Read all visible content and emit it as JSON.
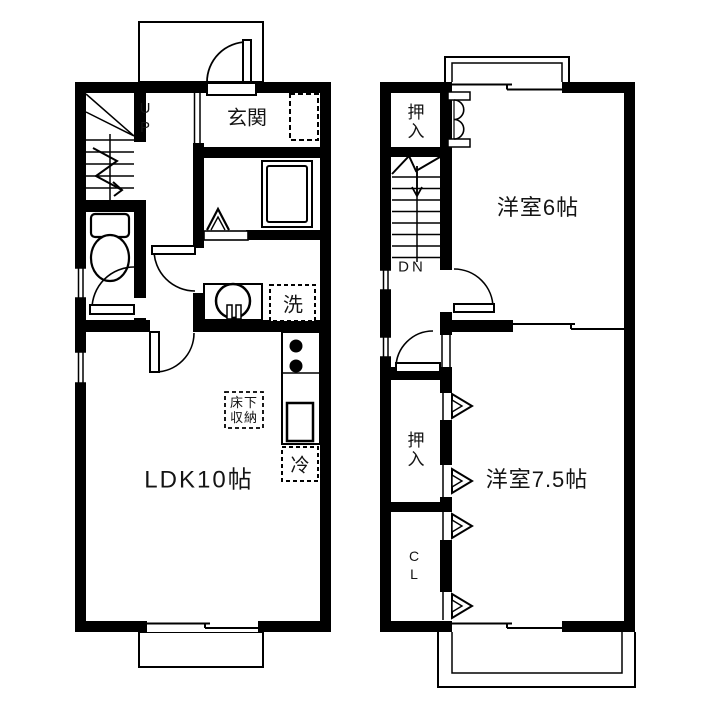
{
  "floor1": {
    "stairs_label": "UP",
    "entrance_label": "玄関",
    "laundry_label": "洗",
    "floor_storage_label": "床下収納",
    "refrigerator_label": "冷",
    "ldk_label": "LDK10帖"
  },
  "floor2": {
    "closet_top_label": "押入",
    "stairs_label": "DN",
    "room_6_label": "洋室6帖",
    "closet_bottom_label": "押入",
    "closet_cl_label": "CL",
    "room_75_label": "洋室7.5帖"
  },
  "colors": {
    "wall": "#000000",
    "background": "#ffffff"
  }
}
